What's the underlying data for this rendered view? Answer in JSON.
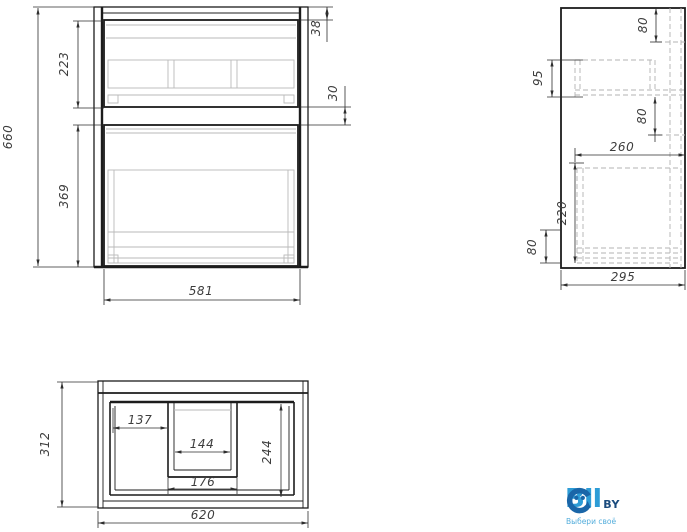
{
  "views": {
    "front": {
      "dims": {
        "overall_height": "660",
        "top_drawer_face": "223",
        "bottom_drawer_face": "369",
        "top_reveal": "38",
        "drawer_gap": "30",
        "width": "581"
      }
    },
    "side": {
      "dims": {
        "top_inset": "80",
        "rail_height": "95",
        "mid_inset": "80",
        "inner_width": "260",
        "drawer_depth": "220",
        "bottom_inset": "80",
        "depth": "295"
      }
    },
    "plan": {
      "dims": {
        "depth": "312",
        "left_bay_width": "137",
        "cutout_inner_width": "144",
        "bay_depth": "244",
        "cutout_outer_width": "176",
        "overall_width": "620"
      }
    },
    "logo": {
      "prefix": "BI",
      "mid_letter": "I",
      "suffix": "BY",
      "tagline": "Выбери своё",
      "colors": {
        "letters": "#2D9CD6",
        "icon": "#1A66A8",
        "suffix": "#1A4B7D",
        "tagline": "#55AEDC"
      }
    },
    "drawing_colors": {
      "visible_line": "#1c1c1c",
      "hidden_line": "#b3b3b3",
      "dimension_text": "#3d3d3d",
      "background": "#ffffff"
    }
  }
}
